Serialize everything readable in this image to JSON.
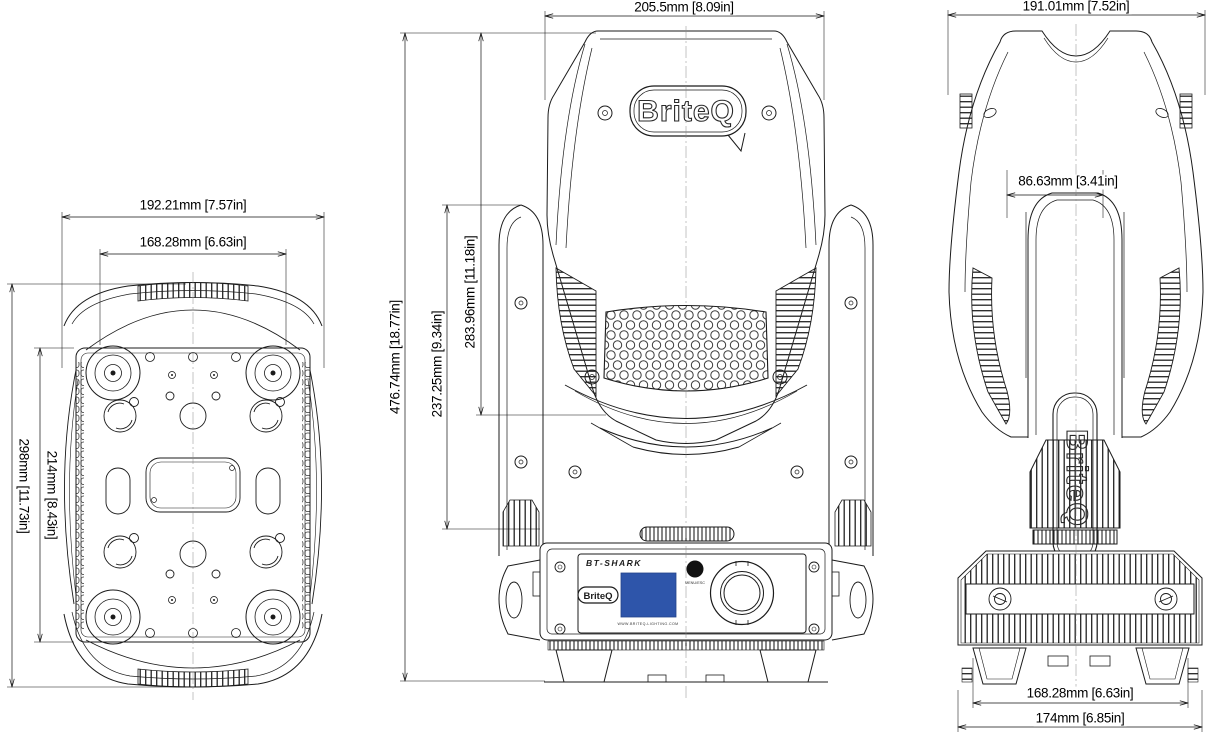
{
  "drawing": {
    "brand": "BriteQ",
    "model": "BT-SHARK",
    "website": "WWW.BRITEQ-LIGHTING.COM",
    "menu_button_label": "MENU/ESC",
    "screen_color": "#2E55AA"
  },
  "dimensions": {
    "bottom_view": {
      "outer_width": "192.21mm [7.57in]",
      "inner_width": "168.28mm [6.63in]",
      "outer_length": "298mm [11.73in]",
      "inner_length": "214mm [8.43in]"
    },
    "front_view": {
      "head_width": "205.5mm [8.09in]",
      "total_height": "476.74mm [18.77in]",
      "head_height": "283.96mm [11.18in]",
      "yoke_height": "237.25mm [9.34in]"
    },
    "side_view": {
      "overall_depth": "191.01mm [7.52in]",
      "yoke_width": "86.63mm [3.41in]",
      "feet_span": "168.28mm [6.63in]",
      "base_depth": "174mm [6.85in]"
    }
  }
}
